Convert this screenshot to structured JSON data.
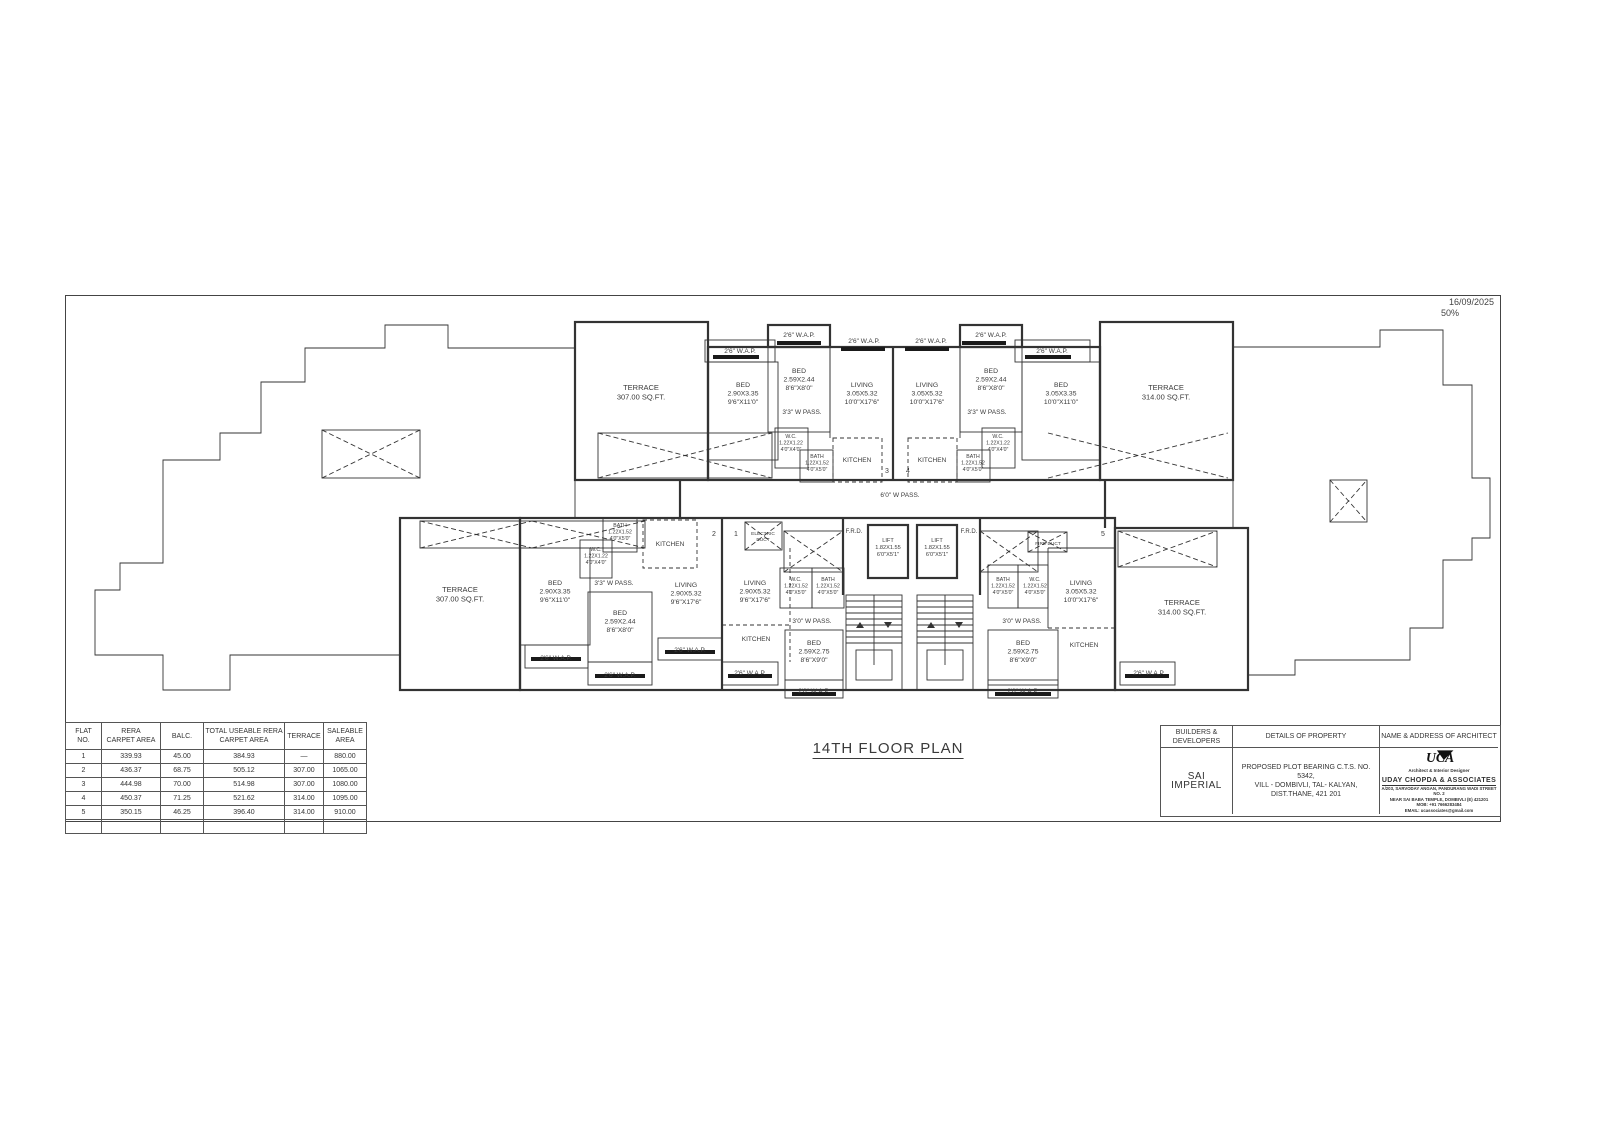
{
  "sheet": {
    "date": "16/09/2025",
    "scale": "50%",
    "title": "14TH FLOOR PLAN"
  },
  "area_table": {
    "headers": [
      "FLAT\nNO.",
      "RERA\nCARPET AREA",
      "BALC.",
      "TOTAL USEABLE RERA\nCARPET AREA",
      "TERRACE",
      "SALEABLE\nAREA"
    ],
    "rows": [
      [
        "1",
        "339.93",
        "45.00",
        "384.93",
        "—",
        "880.00"
      ],
      [
        "2",
        "436.37",
        "68.75",
        "505.12",
        "307.00",
        "1065.00"
      ],
      [
        "3",
        "444.98",
        "70.00",
        "514.98",
        "307.00",
        "1080.00"
      ],
      [
        "4",
        "450.37",
        "71.25",
        "521.62",
        "314.00",
        "1095.00"
      ],
      [
        "5",
        "350.15",
        "46.25",
        "396.40",
        "314.00",
        "910.00"
      ]
    ]
  },
  "title_block": {
    "builders_header": "BUILDERS &\nDEVELOPERS",
    "builders_name": "SAI IMPERIAL",
    "property_header": "DETAILS OF PROPERTY",
    "property_text": "PROPOSED PLOT BEARING C.T.S. NO. 5342,\nVILL - DOMBIVLI, TAL- KALYAN,\nDIST.THANE, 421 201",
    "architect_header": "NAME & ADDRESS OF ARCHITECT",
    "architect_logo": "UCA",
    "architect_tagline": "Architect & Interior Designer",
    "architect_name": "UDAY CHOPDA & ASSOCIATES",
    "architect_address1": "A/203, SARVODAY ANGAN, PANDURANG WADI STREET NO. 2",
    "architect_address2": "NEAR SAI BABA TEMPLE, DOMBIVLI (E) 421201",
    "architect_mobile": "MOB: +91 7666283484",
    "architect_email": "EMAIL: ucassociates@gmail.com"
  },
  "plan": {
    "flat_markers": [
      {
        "x": 822,
        "y": 178,
        "n": "3"
      },
      {
        "x": 843,
        "y": 178,
        "n": "4"
      },
      {
        "x": 649,
        "y": 241,
        "n": "2"
      },
      {
        "x": 671,
        "y": 241,
        "n": "1"
      },
      {
        "x": 1038,
        "y": 241,
        "n": "5"
      }
    ],
    "labels": [
      {
        "x": 576,
        "y": 95,
        "size": 7.5,
        "lines": [
          "TERRACE",
          "307.00 SQ.FT."
        ]
      },
      {
        "x": 675,
        "y": 58,
        "size": 6.5,
        "lines": [
          "2'6\" W.A.P."
        ]
      },
      {
        "x": 678,
        "y": 92,
        "size": 6.8,
        "lines": [
          "BED",
          "2.90X3.35",
          "9'6\"X11'0\""
        ]
      },
      {
        "x": 734,
        "y": 42,
        "size": 6.5,
        "lines": [
          "2'6\" W.A.P."
        ]
      },
      {
        "x": 734,
        "y": 78,
        "size": 6.8,
        "lines": [
          "BED",
          "2.59X2.44",
          "8'6\"X8'0\""
        ]
      },
      {
        "x": 737,
        "y": 119,
        "size": 6.5,
        "lines": [
          "3'3\" W PASS."
        ]
      },
      {
        "x": 726,
        "y": 143,
        "size": 5.2,
        "lines": [
          "W.C.",
          "1.22X1.22",
          "4'0\"X4'0\""
        ]
      },
      {
        "x": 752,
        "y": 163,
        "size": 5.2,
        "lines": [
          "BATH",
          "1.22X1.52",
          "4'0\"X5'0\""
        ]
      },
      {
        "x": 792,
        "y": 167,
        "size": 6.5,
        "lines": [
          "KITCHEN"
        ]
      },
      {
        "x": 797,
        "y": 92,
        "size": 6.8,
        "lines": [
          "LIVING",
          "3.05X5.32",
          "10'0\"X17'6\""
        ]
      },
      {
        "x": 799,
        "y": 48,
        "size": 6.5,
        "lines": [
          "2'6\" W.A.P."
        ]
      },
      {
        "x": 866,
        "y": 48,
        "size": 6.5,
        "lines": [
          "2'6\" W.A.P."
        ]
      },
      {
        "x": 862,
        "y": 92,
        "size": 6.8,
        "lines": [
          "LIVING",
          "3.05X5.32",
          "10'0\"X17'6\""
        ]
      },
      {
        "x": 867,
        "y": 167,
        "size": 6.5,
        "lines": [
          "KITCHEN"
        ]
      },
      {
        "x": 908,
        "y": 163,
        "size": 5.2,
        "lines": [
          "BATH",
          "1.22X1.52",
          "4'0\"X5'0\""
        ]
      },
      {
        "x": 933,
        "y": 143,
        "size": 5.2,
        "lines": [
          "W.C.",
          "1.22X1.22",
          "4'0\"X4'0\""
        ]
      },
      {
        "x": 922,
        "y": 119,
        "size": 6.5,
        "lines": [
          "3'3\" W PASS."
        ]
      },
      {
        "x": 926,
        "y": 78,
        "size": 6.8,
        "lines": [
          "BED",
          "2.59X2.44",
          "8'6\"X8'0\""
        ]
      },
      {
        "x": 926,
        "y": 42,
        "size": 6.5,
        "lines": [
          "2'6\" W.A.P."
        ]
      },
      {
        "x": 996,
        "y": 92,
        "size": 6.8,
        "lines": [
          "BED",
          "3.05X3.35",
          "10'0\"X11'0\""
        ]
      },
      {
        "x": 987,
        "y": 58,
        "size": 6.5,
        "lines": [
          "2'6\" W.A.P."
        ]
      },
      {
        "x": 1101,
        "y": 95,
        "size": 7.5,
        "lines": [
          "TERRACE",
          "314.00 SQ.FT."
        ]
      },
      {
        "x": 835,
        "y": 202,
        "size": 6.5,
        "lines": [
          "6'0\" W PASS."
        ]
      },
      {
        "x": 395,
        "y": 297,
        "size": 7.5,
        "lines": [
          "TERRACE",
          "307.00 SQ.FT."
        ]
      },
      {
        "x": 490,
        "y": 290,
        "size": 6.8,
        "lines": [
          "BED",
          "2.90X3.35",
          "9'6\"X11'0\""
        ]
      },
      {
        "x": 491,
        "y": 365,
        "size": 6.5,
        "lines": [
          "2'6\" W.A.P."
        ]
      },
      {
        "x": 531,
        "y": 256,
        "size": 5.2,
        "lines": [
          "W.C.",
          "1.22X1.22",
          "4'0\"X4'0\""
        ]
      },
      {
        "x": 555,
        "y": 232,
        "size": 5.2,
        "lines": [
          "BATH",
          "1.22X1.52",
          "4'0\"X5'0\""
        ]
      },
      {
        "x": 549,
        "y": 290,
        "size": 6.5,
        "lines": [
          "3'3\" W PASS."
        ]
      },
      {
        "x": 555,
        "y": 320,
        "size": 6.8,
        "lines": [
          "BED",
          "2.59X2.44",
          "8'6\"X8'0\""
        ]
      },
      {
        "x": 555,
        "y": 382,
        "size": 6.5,
        "lines": [
          "2'6\" W.A.P."
        ]
      },
      {
        "x": 605,
        "y": 251,
        "size": 6.5,
        "lines": [
          "KITCHEN"
        ]
      },
      {
        "x": 621,
        "y": 292,
        "size": 6.8,
        "lines": [
          "LIVING",
          "2.90X5.32",
          "9'6\"X17'6\""
        ]
      },
      {
        "x": 625,
        "y": 357,
        "size": 6.5,
        "lines": [
          "2'6\" W.A.P."
        ]
      },
      {
        "x": 690,
        "y": 290,
        "size": 6.8,
        "lines": [
          "LIVING",
          "2.90X5.32",
          "9'6\"X17'6\""
        ]
      },
      {
        "x": 691,
        "y": 346,
        "size": 6.5,
        "lines": [
          "KITCHEN"
        ]
      },
      {
        "x": 685,
        "y": 380,
        "size": 6.5,
        "lines": [
          "2'6\" W.A.P."
        ]
      },
      {
        "x": 698,
        "y": 240,
        "size": 4.8,
        "lines": [
          "ELECTRIC",
          "DUCT"
        ]
      },
      {
        "x": 731,
        "y": 286,
        "size": 5.2,
        "lines": [
          "W.C.",
          "1.22X1.52",
          "4'0\"X5'0\""
        ]
      },
      {
        "x": 763,
        "y": 286,
        "size": 5.2,
        "lines": [
          "BATH",
          "1.22X1.52",
          "4'0\"X5'0\""
        ]
      },
      {
        "x": 747,
        "y": 328,
        "size": 6.5,
        "lines": [
          "3'0\" W PASS."
        ]
      },
      {
        "x": 749,
        "y": 350,
        "size": 6.8,
        "lines": [
          "BED",
          "2.59X2.75",
          "8'6\"X9'0\""
        ]
      },
      {
        "x": 749,
        "y": 398,
        "size": 6.5,
        "lines": [
          "2'6\" W.A.P."
        ]
      },
      {
        "x": 789,
        "y": 238,
        "size": 6,
        "lines": [
          "F.R.D."
        ]
      },
      {
        "x": 823,
        "y": 247,
        "size": 5.6,
        "lines": [
          "LIFT",
          "1.82X1.55",
          "6'0\"X5'1\""
        ]
      },
      {
        "x": 872,
        "y": 247,
        "size": 5.6,
        "lines": [
          "LIFT",
          "1.82X1.55",
          "6'0\"X5'1\""
        ]
      },
      {
        "x": 904,
        "y": 238,
        "size": 6,
        "lines": [
          "F.R.D."
        ]
      },
      {
        "x": 983,
        "y": 250,
        "size": 4.8,
        "lines": [
          "FIRE DUCT"
        ]
      },
      {
        "x": 938,
        "y": 286,
        "size": 5.2,
        "lines": [
          "BATH",
          "1.22X1.52",
          "4'0\"X5'0\""
        ]
      },
      {
        "x": 970,
        "y": 286,
        "size": 5.2,
        "lines": [
          "W.C.",
          "1.22X1.52",
          "4'0\"X5'0\""
        ]
      },
      {
        "x": 957,
        "y": 328,
        "size": 6.5,
        "lines": [
          "3'0\" W PASS."
        ]
      },
      {
        "x": 958,
        "y": 350,
        "size": 6.8,
        "lines": [
          "BED",
          "2.59X2.75",
          "8'6\"X9'0\""
        ]
      },
      {
        "x": 958,
        "y": 398,
        "size": 6.5,
        "lines": [
          "2'6\" W.A.P."
        ]
      },
      {
        "x": 1016,
        "y": 290,
        "size": 6.8,
        "lines": [
          "LIVING",
          "3.05X5.32",
          "10'0\"X17'6\""
        ]
      },
      {
        "x": 1019,
        "y": 352,
        "size": 6.5,
        "lines": [
          "KITCHEN"
        ]
      },
      {
        "x": 1084,
        "y": 380,
        "size": 6.5,
        "lines": [
          "2'6\" W.A.P."
        ]
      },
      {
        "x": 1117,
        "y": 310,
        "size": 7.5,
        "lines": [
          "TERRACE",
          "314.00 SQ.FT."
        ]
      }
    ]
  }
}
